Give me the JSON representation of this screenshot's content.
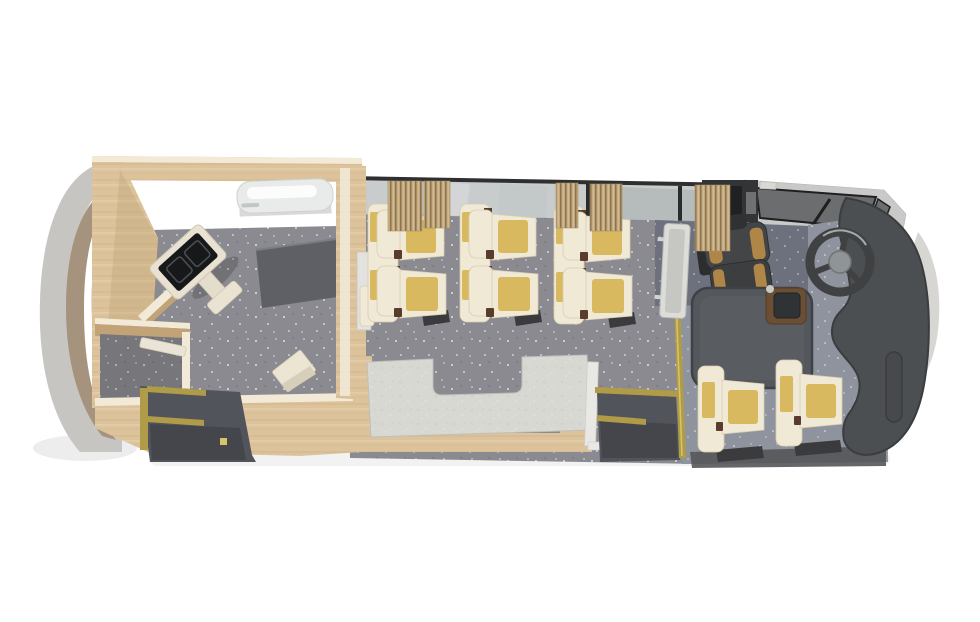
{
  "scene": {
    "description": "Top-down 3D cutaway render of a converted single-deck bus interior",
    "orientation": {
      "rear": "left",
      "front": "right"
    },
    "areas": [
      "rear-cabin-room",
      "rear-stairwell",
      "passenger-seating",
      "galley-counter",
      "front-entry-stairwell",
      "driver-cockpit"
    ],
    "objects": {
      "rear_room": [
        "wood-partition-walls",
        "wall-ac-unit",
        "tv-on-stand",
        "dark-floor-mat",
        "small-closet",
        "step-stool"
      ],
      "seating": [
        "double-seat-row-1",
        "double-seat-row-2",
        "double-seat-row-3",
        "single-seat-1",
        "single-seat-2",
        "driver-seat"
      ],
      "cockpit": [
        "steering-wheel",
        "dashboard",
        "engine-cover",
        "shifter-console",
        "windshield",
        "driver-overhead-console"
      ],
      "fixtures": [
        "window-band",
        "curtain-1",
        "curtain-2",
        "curtain-3",
        "curtain-4",
        "curtain-5",
        "gold-handrails",
        "counter-with-notch",
        "modesty-panel",
        "aisle-door-panel",
        "counter-end-panel"
      ]
    }
  },
  "palette": {
    "white": "#ffffff",
    "wood": "#dcc39c",
    "woodLight": "#ead9b8",
    "woodGrain": "#c9a878",
    "woodDark": "#c2a377",
    "woodEdge": "#f2e9d7",
    "floor": "#8a8a90",
    "floorDark": "#6d717e",
    "floorMid": "#8f939d",
    "speckle": "#cfeaea",
    "wellDark": "#51545a",
    "wellDarker": "#44464b",
    "counter": "#d8d8d3",
    "counterDot": "#b9b9b6",
    "gold": "#b09c48",
    "goldLight": "#d8c468",
    "glass": "#c9cccd",
    "glassShade": "#aeb3b5",
    "windshield": "#6b6d6f",
    "frameLight": "#c9c9c7",
    "lineDark": "#2f2f2f",
    "sill": "#e5e5e2",
    "curtain": "#c3a87e",
    "curtainStripe": "#8d7450",
    "curtainLight": "#d8c297",
    "seatCream": "#f0e9d6",
    "seatCreamShade": "#d8cdb2",
    "seatYellow": "#d9b95f",
    "seatDark": "#3b3b3d",
    "armBrown": "#5a3c2c",
    "driverSeat": "#3c3e40",
    "driverSeatBack": "#434546",
    "headrestDark": "#2f3132",
    "tanSeat": "#b08648",
    "dash": "#4c4f51",
    "dashDark": "#3a3d3f",
    "dashPill": "#47494c",
    "engine": "#54575b",
    "engineEdge": "#3e4145",
    "consoleBrown": "#6b4f35",
    "consoleScreen": "#303335",
    "wheelRing": "#3f4142",
    "wheelHub": "#8f9596",
    "bodyGray": "#c7c5c2",
    "bodyTan": "#a6937e",
    "bodyShadow": "#8a7c6c",
    "mat": "#5f6066",
    "matEdge": "#7c7d82",
    "acUnit": "#e9ebeb",
    "tvFrame": "#e9e2d2",
    "tvScreen": "#16181a",
    "tvGlyph": "#4a4e50",
    "panelWhite": "#dcdcd8",
    "panelShade": "#c6c7c3",
    "overheadDark": "#323436"
  }
}
